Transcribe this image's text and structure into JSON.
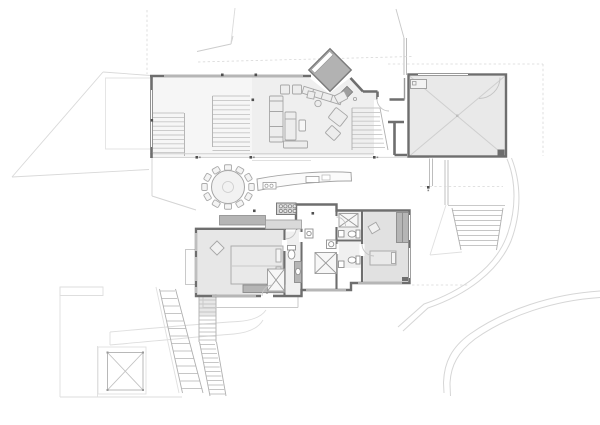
{
  "canvas": {
    "width": 600,
    "height": 425
  },
  "colors": {
    "background": "#ffffff",
    "wall": "#6e6e6e",
    "wall_thin": "#9a9a9a",
    "wall_light": "#bdbdbd",
    "floor_living": "#efefef",
    "floor_stairhall": "#f6f6f6",
    "floor_garage": "#e9e9e9",
    "floor_master": "#e7e7e7",
    "floor_bedroom": "#e1e1e1",
    "floor_bath": "#f0f0f0",
    "fireplace_fill": "#b2b2b2",
    "fireplace_stroke": "#7a7a7a",
    "cabinet": "#b5b5b5",
    "counter_light": "#d9d9d9",
    "furniture_fill": "#ededed",
    "furniture_stroke": "#a6a6a6",
    "fixture_stroke": "#8f8f8f",
    "tread": "#c6c6c6",
    "rail": "#b0b0b0",
    "edge_light": "#cfcfcf",
    "site": "#d9d9d9",
    "contour": "#d6d6d6",
    "dashed": "#d8d8d8",
    "terrace": "#dedede",
    "cross": "#cfcfcf",
    "cross_frame": "#b8b8b8",
    "door_arc": "#c4c4c4",
    "column": "#4f4f4f",
    "white": "#ffffff"
  },
  "features": {
    "site": [
      "property-boundary-lines",
      "topographic-contour-lines",
      "terrace-outline",
      "skylight-cross",
      "exterior-stairs",
      "driveway-path"
    ],
    "upper_block": [
      "stair-hall",
      "main-staircase",
      "living-room",
      "diagonal-fireplace",
      "entry-hall",
      "entry-steps",
      "garage-with-cross"
    ],
    "center_band": [
      "round-dining-table",
      "dining-chairs",
      "curved-kitchen-island",
      "island-sink",
      "range-cooktop",
      "kitchen-counter"
    ],
    "bedroom_wing": [
      "master-bedroom",
      "master-bed",
      "master-bathroom",
      "shower-closet-cross",
      "hall-closet-cross",
      "bathroom-one",
      "bathroom-two",
      "second-bedroom",
      "wardrobe",
      "deck",
      "balcony"
    ]
  }
}
